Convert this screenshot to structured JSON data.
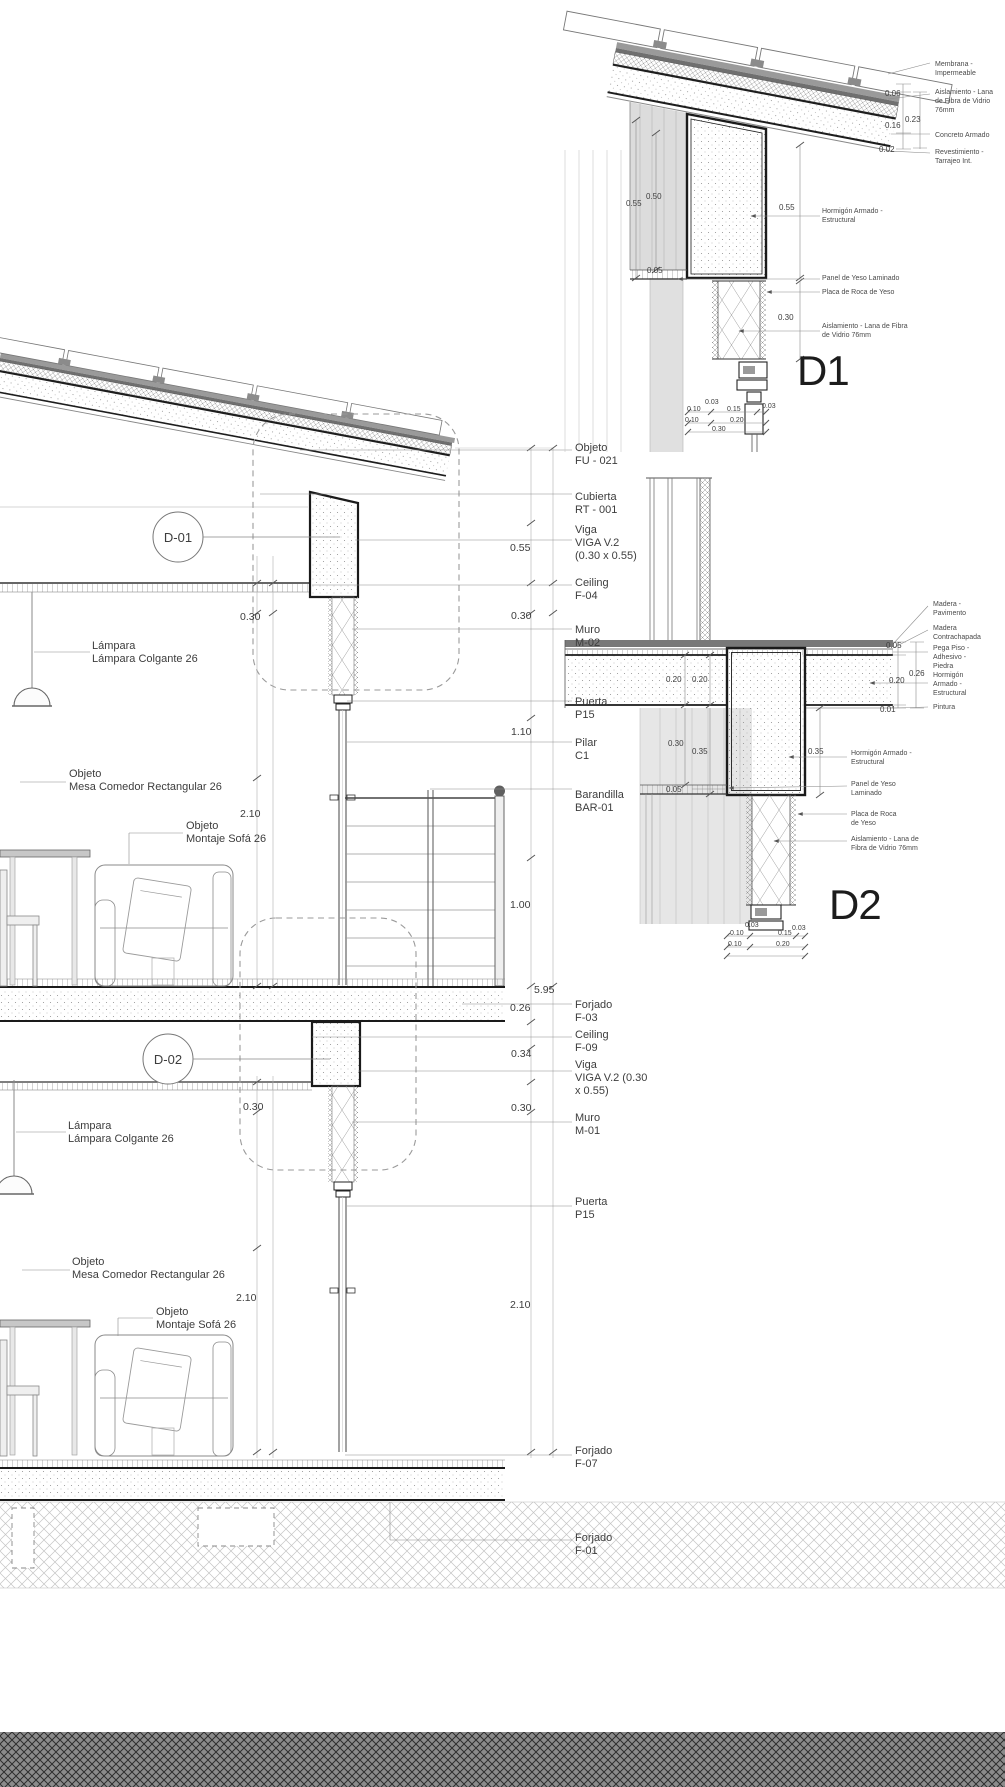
{
  "colors": {
    "wall_fill": "#dcdcdc",
    "ground_band": "#8b8b8b",
    "strong_line": "#1a1a1a"
  },
  "d1": {
    "title": "D1",
    "labels": {
      "membrana": "Membrana -\nImpermeable",
      "aislamiento_roof": "Aislamiento - Lana\nde Fibra de Vidrio\n76mm",
      "concreto": "Concreto Armado",
      "revestimiento": "Revestimiento -\nTarrajeo Int.",
      "hormigon": "Hormigón Armado -\nEstructural",
      "panel_yeso": "Panel de Yeso Laminado",
      "placa_yeso": "Placa de Roca de Yeso",
      "aislamiento_muro": "Aislamiento - Lana de Fibra\nde Vidrio 76mm"
    },
    "dims": {
      "roof_06": "0.06",
      "roof_23": "0.23",
      "roof_16": "0.16",
      "roof_02": "0.02",
      "left_55": "0.55",
      "left_50": "0.50",
      "left_05": "0.05",
      "right_55": "0.55",
      "right_30": "0.30",
      "b_03a": "0.03",
      "b_10a": "0.10",
      "b_15": "0.15",
      "b_03b": "0.03",
      "b_10b": "0.10",
      "b_20": "0.20",
      "b_30": "0.30"
    }
  },
  "d2": {
    "title": "D2",
    "labels": {
      "madera_pav": "Madera -\nPavimento",
      "madera_contra": "Madera\nContrachapada",
      "pega_piso": "Pega Piso -\nAdhesivo -\nPiedra",
      "hormigon_right": "Hormigón\nArmado -\nEstructural",
      "pintura": "Pintura",
      "hormigon_mid": "Hormigón Armado -\nEstructural",
      "panel_yeso": "Panel de Yeso\nLaminado",
      "placa_yeso": "Placa de Roca\nde Yeso",
      "aislamiento": "Aislamiento - Lana de\nFibra de Vidrio 76mm"
    },
    "dims": {
      "f_05": "0.05",
      "f_26": "0.26",
      "f_20r": "0.20",
      "f_01": "0.01",
      "s_20a": "0.20",
      "s_20b": "0.20",
      "w_30": "0.30",
      "w_35": "0.35",
      "w_05": "0.05",
      "r_35": "0.35",
      "b_03a": "0.03",
      "b_10a": "0.10",
      "b_15": "0.15",
      "b_03b": "0.03",
      "b_10b": "0.10",
      "b_20": "0.20"
    }
  },
  "section": {
    "bubbles": {
      "d01": "D-01",
      "d02": "D-02"
    },
    "right": {
      "objeto_fu": "Objeto\nFU - 021",
      "cubierta": "Cubierta\nRT - 001",
      "viga_sup": "Viga\nVIGA V.2\n(0.30 x 0.55)",
      "ceiling_sup": "Ceiling\nF-04",
      "muro_sup": "Muro\nM-02",
      "puerta_sup": "Puerta\nP15",
      "pilar": "Pilar\nC1",
      "barandilla": "Barandilla\nBAR-01",
      "forjado_f03": "Forjado\nF-03",
      "ceiling_inf": "Ceiling\nF-09",
      "viga_inf": "Viga\nVIGA V.2 (0.30\nx 0.55)",
      "muro_inf": "Muro\nM-01",
      "puerta_inf": "Puerta\nP15",
      "forjado_f07": "Forjado\nF-07",
      "forjado_f01": "Forjado\nF-01"
    },
    "left": {
      "lampara_sup": "Lámpara\nLámpara Colgante 26",
      "mesa_sup": "Objeto\nMesa Comedor Rectangular 26",
      "sofa_sup": "Objeto\nMontaje Sofá 26",
      "lampara_inf": "Lámpara\nLámpara Colgante 26",
      "mesa_inf": "Objeto\nMesa Comedor Rectangular 26",
      "sofa_inf": "Objeto\nMontaje Sofá 26"
    },
    "dims": {
      "v055": "0.55",
      "v030a": "0.30",
      "v110": "1.10",
      "v100": "1.00",
      "v595": "5.95",
      "v026": "0.26",
      "v034": "0.34",
      "v030b": "0.30",
      "v210r": "2.10",
      "l030a": "0.30",
      "l210a": "2.10",
      "l030b": "0.30",
      "l210b": "2.10"
    }
  }
}
